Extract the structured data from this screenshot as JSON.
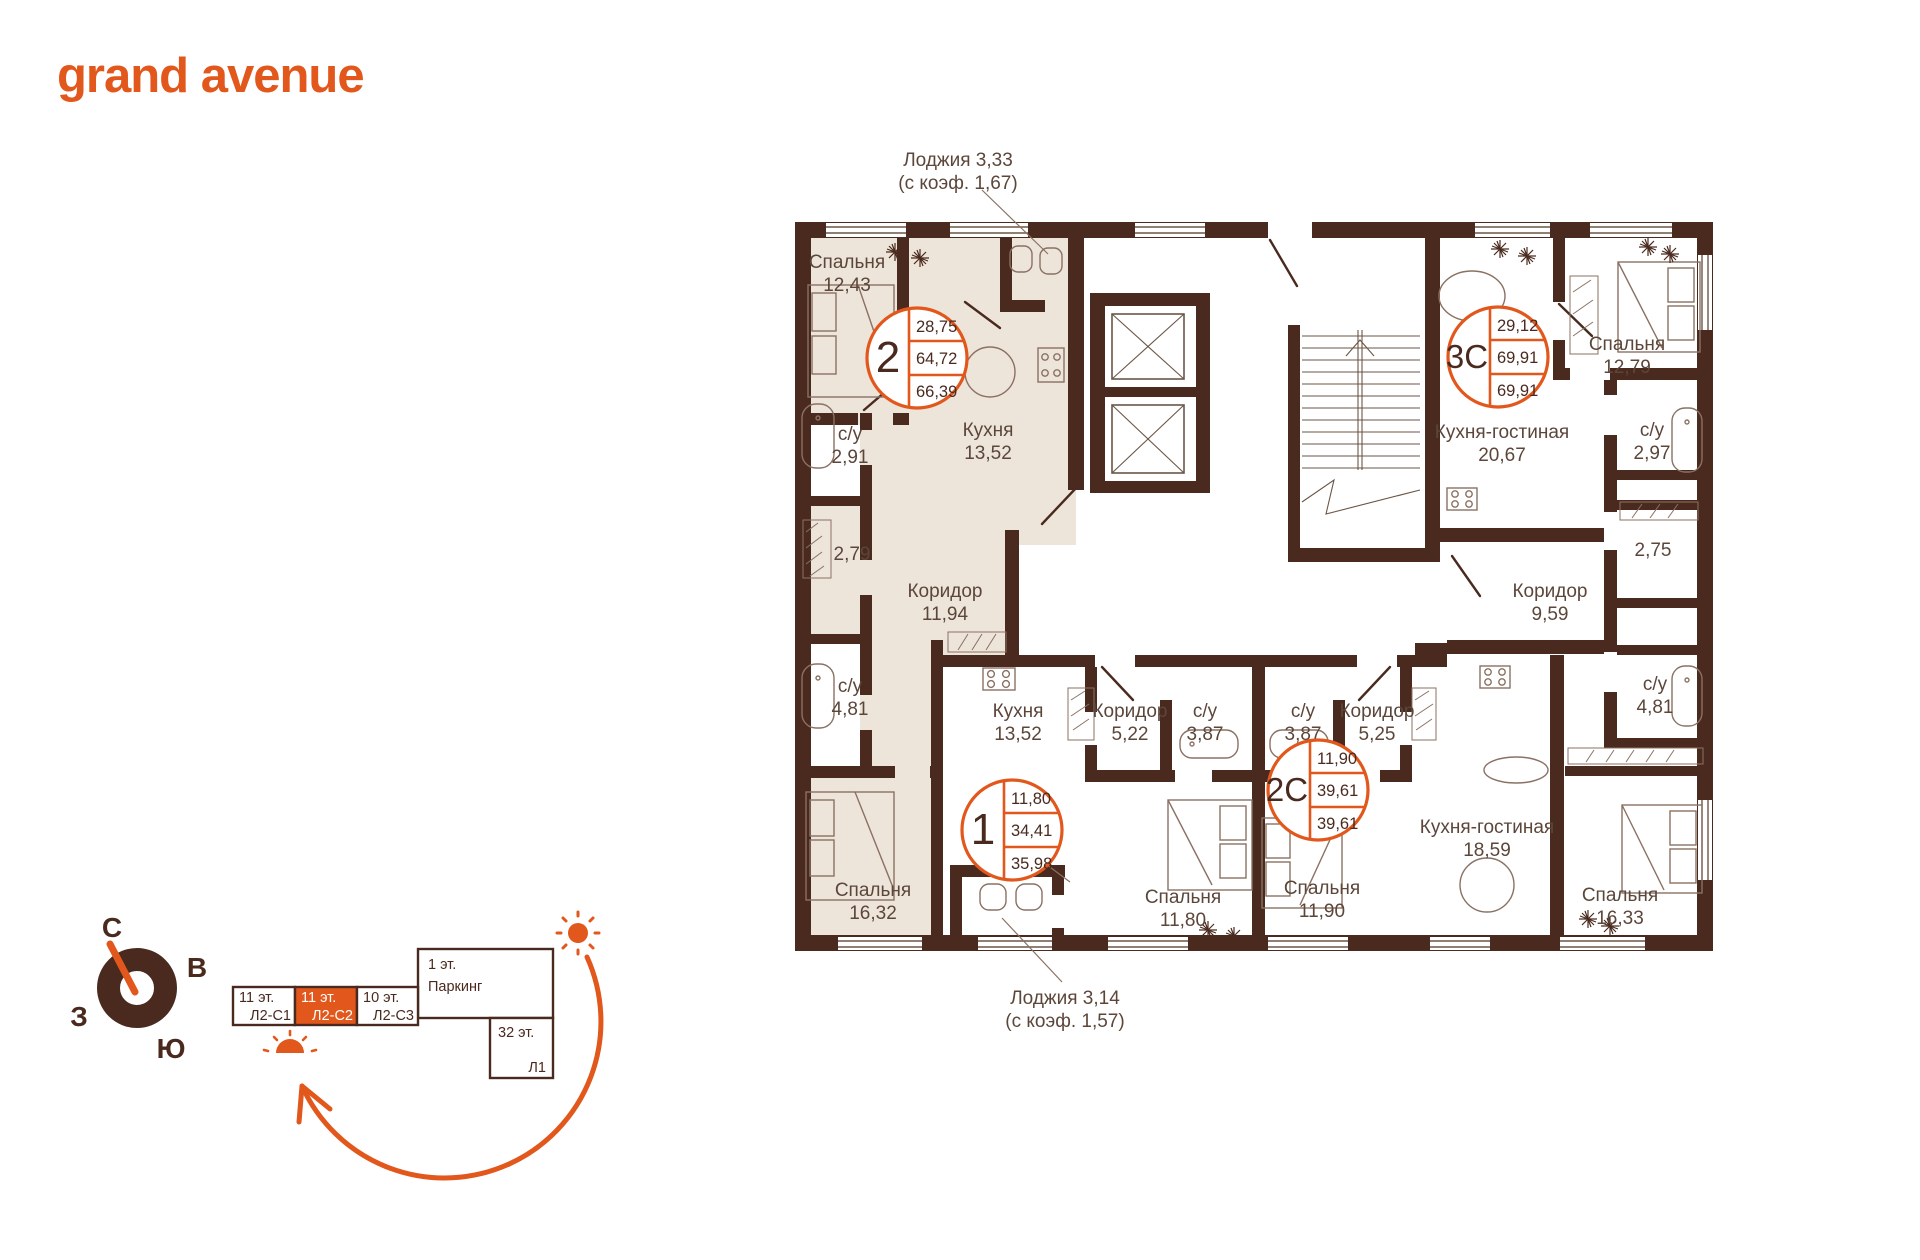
{
  "brand": {
    "logo": "grand avenue"
  },
  "colors": {
    "accent": "#E2571B",
    "wall": "#4A2A1E",
    "floor_highlight": "#EDE5D9",
    "label": "#5C463A"
  },
  "plan": {
    "annotations": {
      "top": {
        "line1": "Лоджия 3,33",
        "line2": "(с коэф. 1,67)"
      },
      "bottom": {
        "line1": "Лоджия 3,14",
        "line2": "(с коэф. 1,57)"
      }
    },
    "units": [
      {
        "id": "2",
        "values": [
          "28,75",
          "64,72",
          "66,39"
        ]
      },
      {
        "id": "3С",
        "values": [
          "29,12",
          "69,91",
          "69,91"
        ]
      },
      {
        "id": "1",
        "values": [
          "11,80",
          "34,41",
          "35,98"
        ]
      },
      {
        "id": "2С",
        "values": [
          "11,90",
          "39,61",
          "39,61"
        ]
      }
    ],
    "rooms": [
      {
        "name": "Спальня",
        "value": "12,43"
      },
      {
        "name": "с/у",
        "value": "2,91"
      },
      {
        "name": "",
        "value": "2,79"
      },
      {
        "name": "с/у",
        "value": "4,81"
      },
      {
        "name": "Спальня",
        "value": "16,32"
      },
      {
        "name": "Кухня",
        "value": "13,52"
      },
      {
        "name": "Коридор",
        "value": "11,94"
      },
      {
        "name": "Кухня",
        "value": "13,52"
      },
      {
        "name": "Коридор",
        "value": "5,22"
      },
      {
        "name": "с/у",
        "value": "3,87"
      },
      {
        "name": "Спальня",
        "value": "11,80"
      },
      {
        "name": "с/у",
        "value": "3,87"
      },
      {
        "name": "Коридор",
        "value": "5,25"
      },
      {
        "name": "Спальня",
        "value": "11,90"
      },
      {
        "name": "Кухня-гостиная",
        "value": "18,59"
      },
      {
        "name": "Спальня",
        "value": "16,33"
      },
      {
        "name": "с/у",
        "value": "4,81"
      },
      {
        "name": "",
        "value": "2,75"
      },
      {
        "name": "Коридор",
        "value": "9,59"
      },
      {
        "name": "Кухня-гостиная",
        "value": "20,67"
      },
      {
        "name": "с/у",
        "value": "2,97"
      },
      {
        "name": "Спальня",
        "value": "12,79"
      }
    ]
  },
  "compass": {
    "north": "С",
    "east": "В",
    "south": "Ю",
    "west": "З"
  },
  "scheme": {
    "cells": [
      {
        "floor": "11 эт.",
        "code": "Л2-С1"
      },
      {
        "floor": "11 эт.",
        "code": "Л2-С2"
      },
      {
        "floor": "10 эт.",
        "code": "Л2-С3"
      }
    ],
    "active_index": 1,
    "parking": {
      "floor": "1 эт.",
      "label": "Паркинг"
    },
    "tower": {
      "floor": "32 эт.",
      "code": "Л1"
    }
  }
}
